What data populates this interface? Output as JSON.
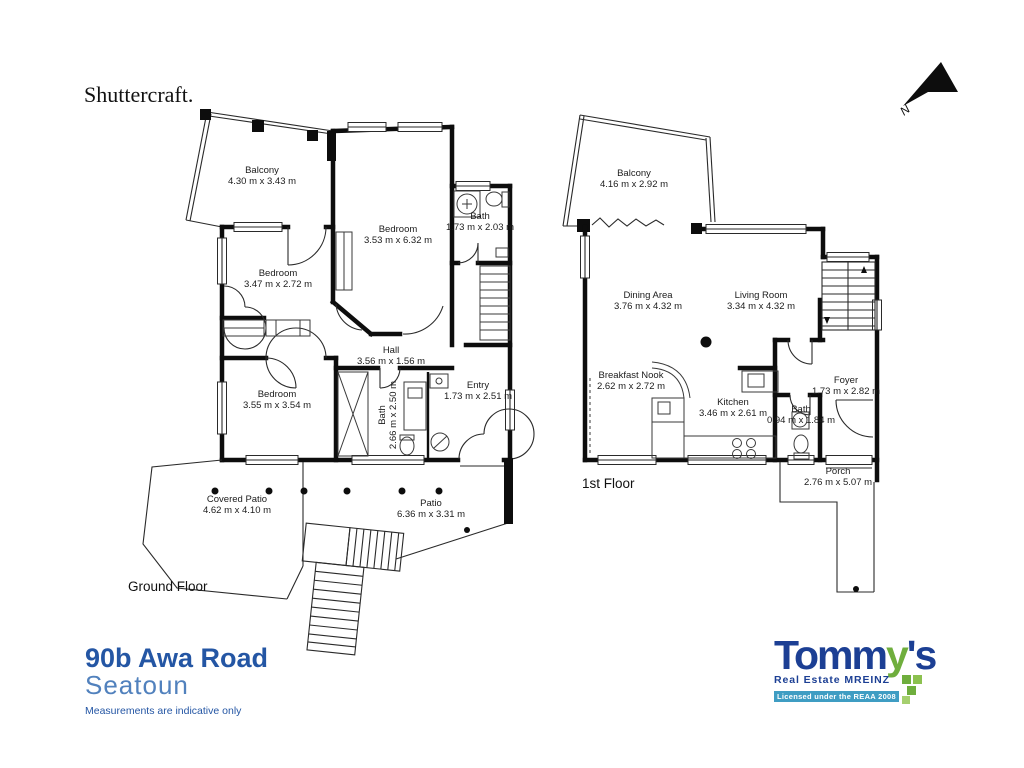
{
  "title": "Shuttercraft.",
  "north_label": "N",
  "floors": {
    "ground": {
      "label": "Ground Floor",
      "rooms": [
        {
          "name": "Balcony",
          "dims": "4.30 m x 3.43 m"
        },
        {
          "name": "Bedroom",
          "dims": "3.53 m x 6.32 m"
        },
        {
          "name": "Bath",
          "dims": "1.73 m x 2.03 m"
        },
        {
          "name": "Bedroom",
          "dims": "3.47 m x 2.72 m"
        },
        {
          "name": "Hall",
          "dims": "3.56 m x 1.56 m"
        },
        {
          "name": "Bedroom",
          "dims": "3.55 m x 3.54 m"
        },
        {
          "name": "Bath",
          "dims": "2.66 m x 2.50 m"
        },
        {
          "name": "Entry",
          "dims": "1.73 m x 2.51 m"
        },
        {
          "name": "Covered Patio",
          "dims": "4.62 m x 4.10 m"
        },
        {
          "name": "Patio",
          "dims": "6.36 m x 3.31 m"
        }
      ]
    },
    "first": {
      "label": "1st Floor",
      "rooms": [
        {
          "name": "Balcony",
          "dims": "4.16 m x 2.92 m"
        },
        {
          "name": "Dining Area",
          "dims": "3.76 m x 4.32 m"
        },
        {
          "name": "Living Room",
          "dims": "3.34 m x 4.32 m"
        },
        {
          "name": "Breakfast Nook",
          "dims": "2.62 m x 2.72 m"
        },
        {
          "name": "Kitchen",
          "dims": "3.46 m x 2.61 m"
        },
        {
          "name": "Bath",
          "dims": "0.94 m x 1.84 m"
        },
        {
          "name": "Foyer",
          "dims": "1.73 m x 2.82 m"
        },
        {
          "name": "Porch",
          "dims": "2.76 m x 5.07 m"
        }
      ]
    }
  },
  "footer": {
    "address_line1": "90b Awa Road",
    "address_line2": "Seatoun",
    "disclaimer": "Measurements are indicative only"
  },
  "branding": {
    "logo_part1": "Tomm",
    "logo_part2": "y",
    "logo_part3": "'s",
    "tagline": "Real Estate MREINZ",
    "license": "Licensed under the REAA 2008",
    "colors": {
      "logo_blue": "#1c3f94",
      "logo_green": "#6fae3d",
      "license_teal": "#3f9dc3",
      "address_blue": "#2456a4",
      "address_light_blue": "#5181bd"
    }
  }
}
